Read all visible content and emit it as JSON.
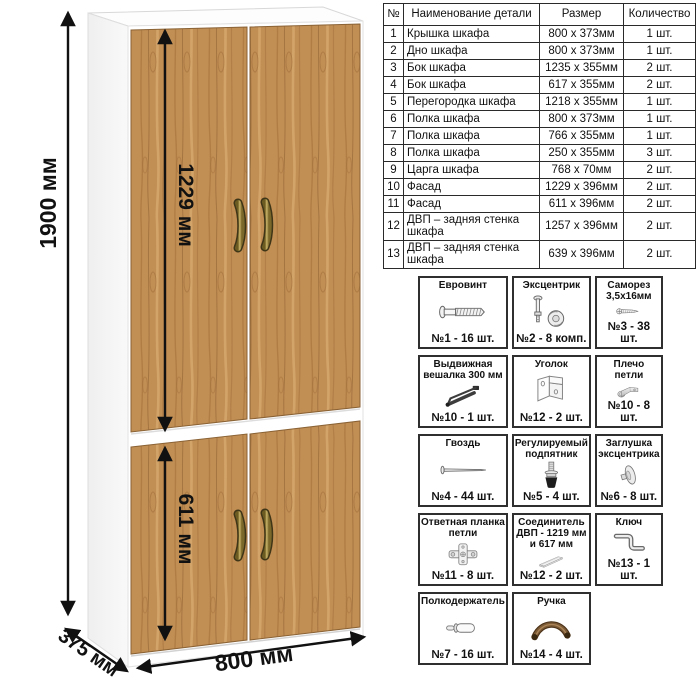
{
  "diagram": {
    "dimensions": {
      "height": "1900 мм",
      "upper_door": "1229 мм",
      "lower_door": "611 мм",
      "width": "800 мм",
      "depth": "375 мм"
    },
    "colors": {
      "door_wood": "#c18e54",
      "wood_grain_dark": "#8e6131",
      "carcass": "#ffffff",
      "handle_brass": "#a08a3a",
      "dimension_lines": "#111111"
    }
  },
  "parts_table": {
    "headers": [
      "№",
      "Наименование детали",
      "Размер",
      "Количество"
    ],
    "rows": [
      [
        "1",
        "Крышка шкафа",
        "800 x 373мм",
        "1 шт."
      ],
      [
        "2",
        "Дно шкафа",
        "800 x 373мм",
        "1 шт."
      ],
      [
        "3",
        "Бок шкафа",
        "1235 x 355мм",
        "2 шт."
      ],
      [
        "4",
        "Бок шкафа",
        "617 x 355мм",
        "2 шт."
      ],
      [
        "5",
        "Перегородка шкафа",
        "1218 x 355мм",
        "1 шт."
      ],
      [
        "6",
        "Полка шкафа",
        "800 x 373мм",
        "1 шт."
      ],
      [
        "7",
        "Полка шкафа",
        "766 x 355мм",
        "1 шт."
      ],
      [
        "8",
        "Полка шкафа",
        "250 x 355мм",
        "3 шт."
      ],
      [
        "9",
        "Царга шкафа",
        "768 x 70мм",
        "2 шт."
      ],
      [
        "10",
        "Фасад",
        "1229 x 396мм",
        "2 шт."
      ],
      [
        "11",
        "Фасад",
        "611 x 396мм",
        "2 шт."
      ],
      [
        "12",
        "ДВП – задняя стенка шкафа",
        "1257 x 396мм",
        "2 шт."
      ],
      [
        "13",
        "ДВП – задняя стенка шкафа",
        "639 x 396мм",
        "2 шт."
      ]
    ]
  },
  "hardware": {
    "items": [
      {
        "title": "Евровинт",
        "count": "№1 - 16 шт.",
        "icon": "euroscrew"
      },
      {
        "title": "Эксцентрик",
        "count": "№2 - 8 комп.",
        "icon": "cam"
      },
      {
        "title": "Саморез 3,5х16мм",
        "count": "№3 - 38 шт.",
        "icon": "screw"
      },
      {
        "title": "Выдвижная вешалка 300 мм",
        "count": "№10 - 1 шт.",
        "icon": "hanger"
      },
      {
        "title": "Уголок",
        "count": "№12 - 2 шт.",
        "icon": "bracket"
      },
      {
        "title": "Плечо петли",
        "count": "№10 - 8 шт.",
        "icon": "hinge-arm"
      },
      {
        "title": "Гвоздь",
        "count": "№4 - 44 шт.",
        "icon": "nail"
      },
      {
        "title": "Регулируемый подпятник",
        "count": "№5 - 4 шт.",
        "icon": "foot"
      },
      {
        "title": "Заглушка эксцентрика",
        "count": "№6 - 8 шт.",
        "icon": "cam-cap"
      },
      {
        "title": "Ответная планка петли",
        "count": "№11 - 8 шт.",
        "icon": "hinge-plate"
      },
      {
        "title": "Соединитель ДВП - 1219 мм и 617 мм",
        "count": "№12 - 2 шт.",
        "icon": "hdf-connector"
      },
      {
        "title": "Ключ",
        "count": "№13 - 1 шт.",
        "icon": "hex-key"
      },
      {
        "title": "Полкодержатель",
        "count": "№7 - 16 шт.",
        "icon": "shelf-pin"
      },
      {
        "title": "Ручка",
        "count": "№14 - 4 шт.",
        "icon": "handle"
      }
    ]
  }
}
